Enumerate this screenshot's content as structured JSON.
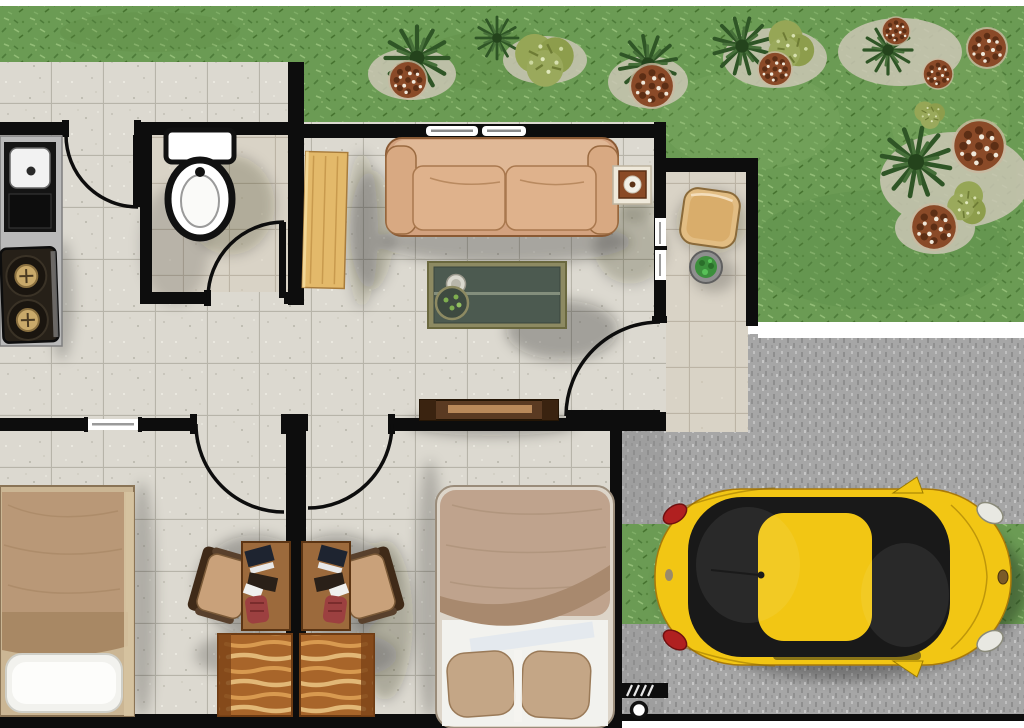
{
  "scene": {
    "title": "house-floor-plan-top-view",
    "description": "top-down rendered floor plan with front yard, side porch, driveway and parked yellow beetle car",
    "rooms": [
      "yard",
      "walkway",
      "kitchen",
      "bathroom",
      "hallway",
      "living-room",
      "bedroom-1",
      "bedroom-2",
      "porch",
      "driveway"
    ],
    "furniture": {
      "kitchen": [
        "counter-with-sink",
        "two-burner-stove"
      ],
      "bathroom": [
        "toilet"
      ],
      "hallway": [
        "wooden-shelf"
      ],
      "living_room": [
        "three-seat-sofa",
        "side-table-with-cup",
        "coffee-table-with-tray",
        "console-table"
      ],
      "bedroom_1": [
        "single-bed",
        "desk-with-chair",
        "striped-dresser"
      ],
      "bedroom_2": [
        "double-bed",
        "desk-with-chair",
        "striped-dresser"
      ],
      "porch": [
        "square-wood-table",
        "potted-plant"
      ],
      "driveway": [
        "yellow-beetle-car",
        "hatched-gate",
        "gate-post"
      ],
      "yard": [
        "fern-palms",
        "olive-shrubs",
        "brown-flower-clusters"
      ]
    },
    "door_swings": [
      "kitchen-entry",
      "bathroom",
      "bedroom-1",
      "bedroom-2",
      "main-entrance"
    ],
    "windows": [
      "living-room-north",
      "living-room-east",
      "bedroom-1-north"
    ]
  },
  "colors": {
    "wall": "#0d0d0d",
    "white": "#ffffff",
    "grass": "#6b9b54",
    "grass_dark": "#4e7c3a",
    "grass_light": "#93bd77",
    "tile": "#dcd9d0",
    "tile_line": "#b7b4a9",
    "bath_tile": "#d9d3c6",
    "bath_tile_line": "#bcb4a5",
    "gravel": "#a6a6a6",
    "gravel_dark": "#8e8e8e",
    "gravel_light": "#c6c6c6",
    "car_body": "#f2c614",
    "car_glass": "#191919",
    "tail_light": "#b02020",
    "head_light": "#e8e8e2",
    "sofa": "#d3a27f",
    "sofa_back": "#e0b896",
    "sofa_cushion": "#dfb28c",
    "side_table": "#8a4a26",
    "coffee_frame": "#8d8a62",
    "coffee_top": "#4c5a50",
    "console": "#5a3a22",
    "console_slat": "#b9895a",
    "shelf_wood": "#e3b96a",
    "counter": "#b9b9b9",
    "stove": "#262018",
    "burner": "#c9a96a",
    "bed1_duvet": "#b99877",
    "bed1_band": "#a88864",
    "bed2_duvet": "#bfa38d",
    "bed2_band": "#a8896e",
    "pillow": "#f2f2ee",
    "bed_pillow_tan": "#c4a686",
    "desk_wood": "#9c6a3c",
    "dresser_wood": "#a8652a",
    "dresser_stripe": "#e2b877",
    "chair_seat": "#c9a17a",
    "chair_back": "#3f2a18",
    "red_cushion": "#9c4040",
    "fern": "#2f5526",
    "bush": "#96a656",
    "pompom": "#8a4a28",
    "porch_table": "#e2bd83",
    "pot_plant": "#3c8f3c"
  }
}
